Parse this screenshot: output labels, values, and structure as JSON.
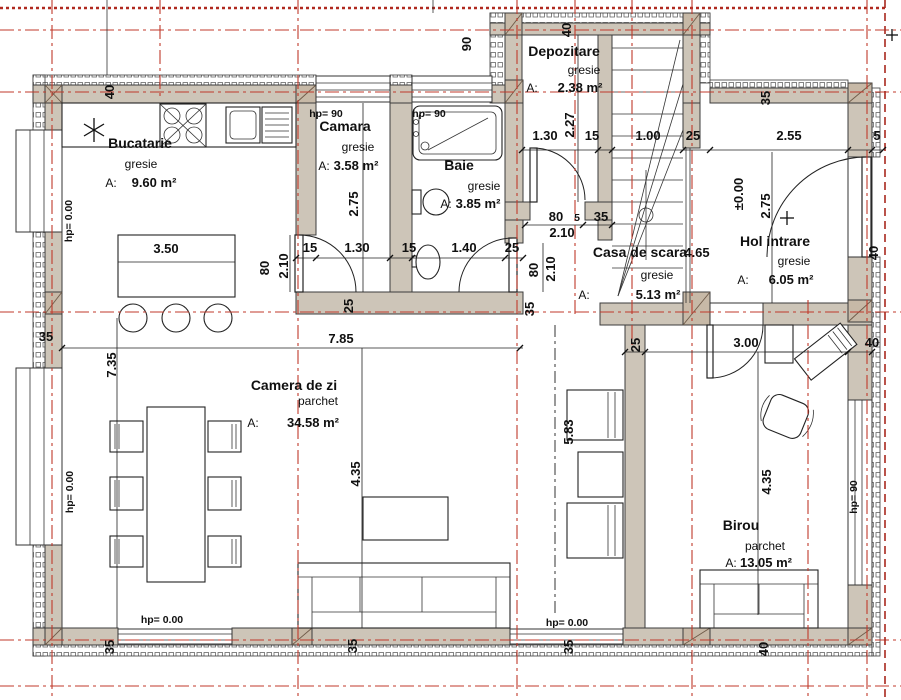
{
  "colors": {
    "axis_red": "#c0392b",
    "wall_fill": "#cdc5b8"
  },
  "rooms": [
    {
      "name": "Bucatarie",
      "finish": "gresie",
      "area_label": "A:",
      "area": "9.60 m²"
    },
    {
      "name": "Camara",
      "finish": "gresie",
      "area_label": "A:",
      "area": "3.58 m²"
    },
    {
      "name": "Baie",
      "finish": "gresie",
      "area_label": "A:",
      "area": "3.85 m²"
    },
    {
      "name": "Depozitare",
      "finish": "gresie",
      "area_label": "A:",
      "area": "2.38 m²"
    },
    {
      "name": "Casa de scara",
      "extra": "4.65",
      "finish": "gresie",
      "area_label": "A:",
      "area": "5.13 m²"
    },
    {
      "name": "Hol intrare",
      "finish": "gresie",
      "area_label": "A:",
      "area": "6.05 m²"
    },
    {
      "name": "Camera de zi",
      "finish": "parchet",
      "area_label": "A:",
      "area": "34.58 m²"
    },
    {
      "name": "Birou",
      "finish": "parchet",
      "area_label": "A:",
      "area": "13.05 m²"
    }
  ],
  "dims": [
    "hp= 90",
    "hp= 90",
    "1.30",
    "15",
    "1.00",
    "25",
    "2.55",
    "5",
    "15",
    "1.30",
    "15",
    "1.40",
    "25",
    "80",
    "5",
    "35",
    "2.10",
    "3.50",
    "7.85",
    "35",
    "3.00",
    "40",
    "hp= 0.00",
    "hp= 0.00",
    "40",
    "90",
    "40",
    "2.27",
    "35",
    "2.75",
    "80",
    "2.10",
    "80",
    "2.10",
    "35",
    "25",
    "7.35",
    "hp= 0.00",
    "hp= 0.00",
    "4.35",
    "5.83",
    "25",
    "4.35",
    "hp= 90",
    "40",
    "35",
    "35",
    "35",
    "40",
    "±0.00",
    "2.75"
  ]
}
